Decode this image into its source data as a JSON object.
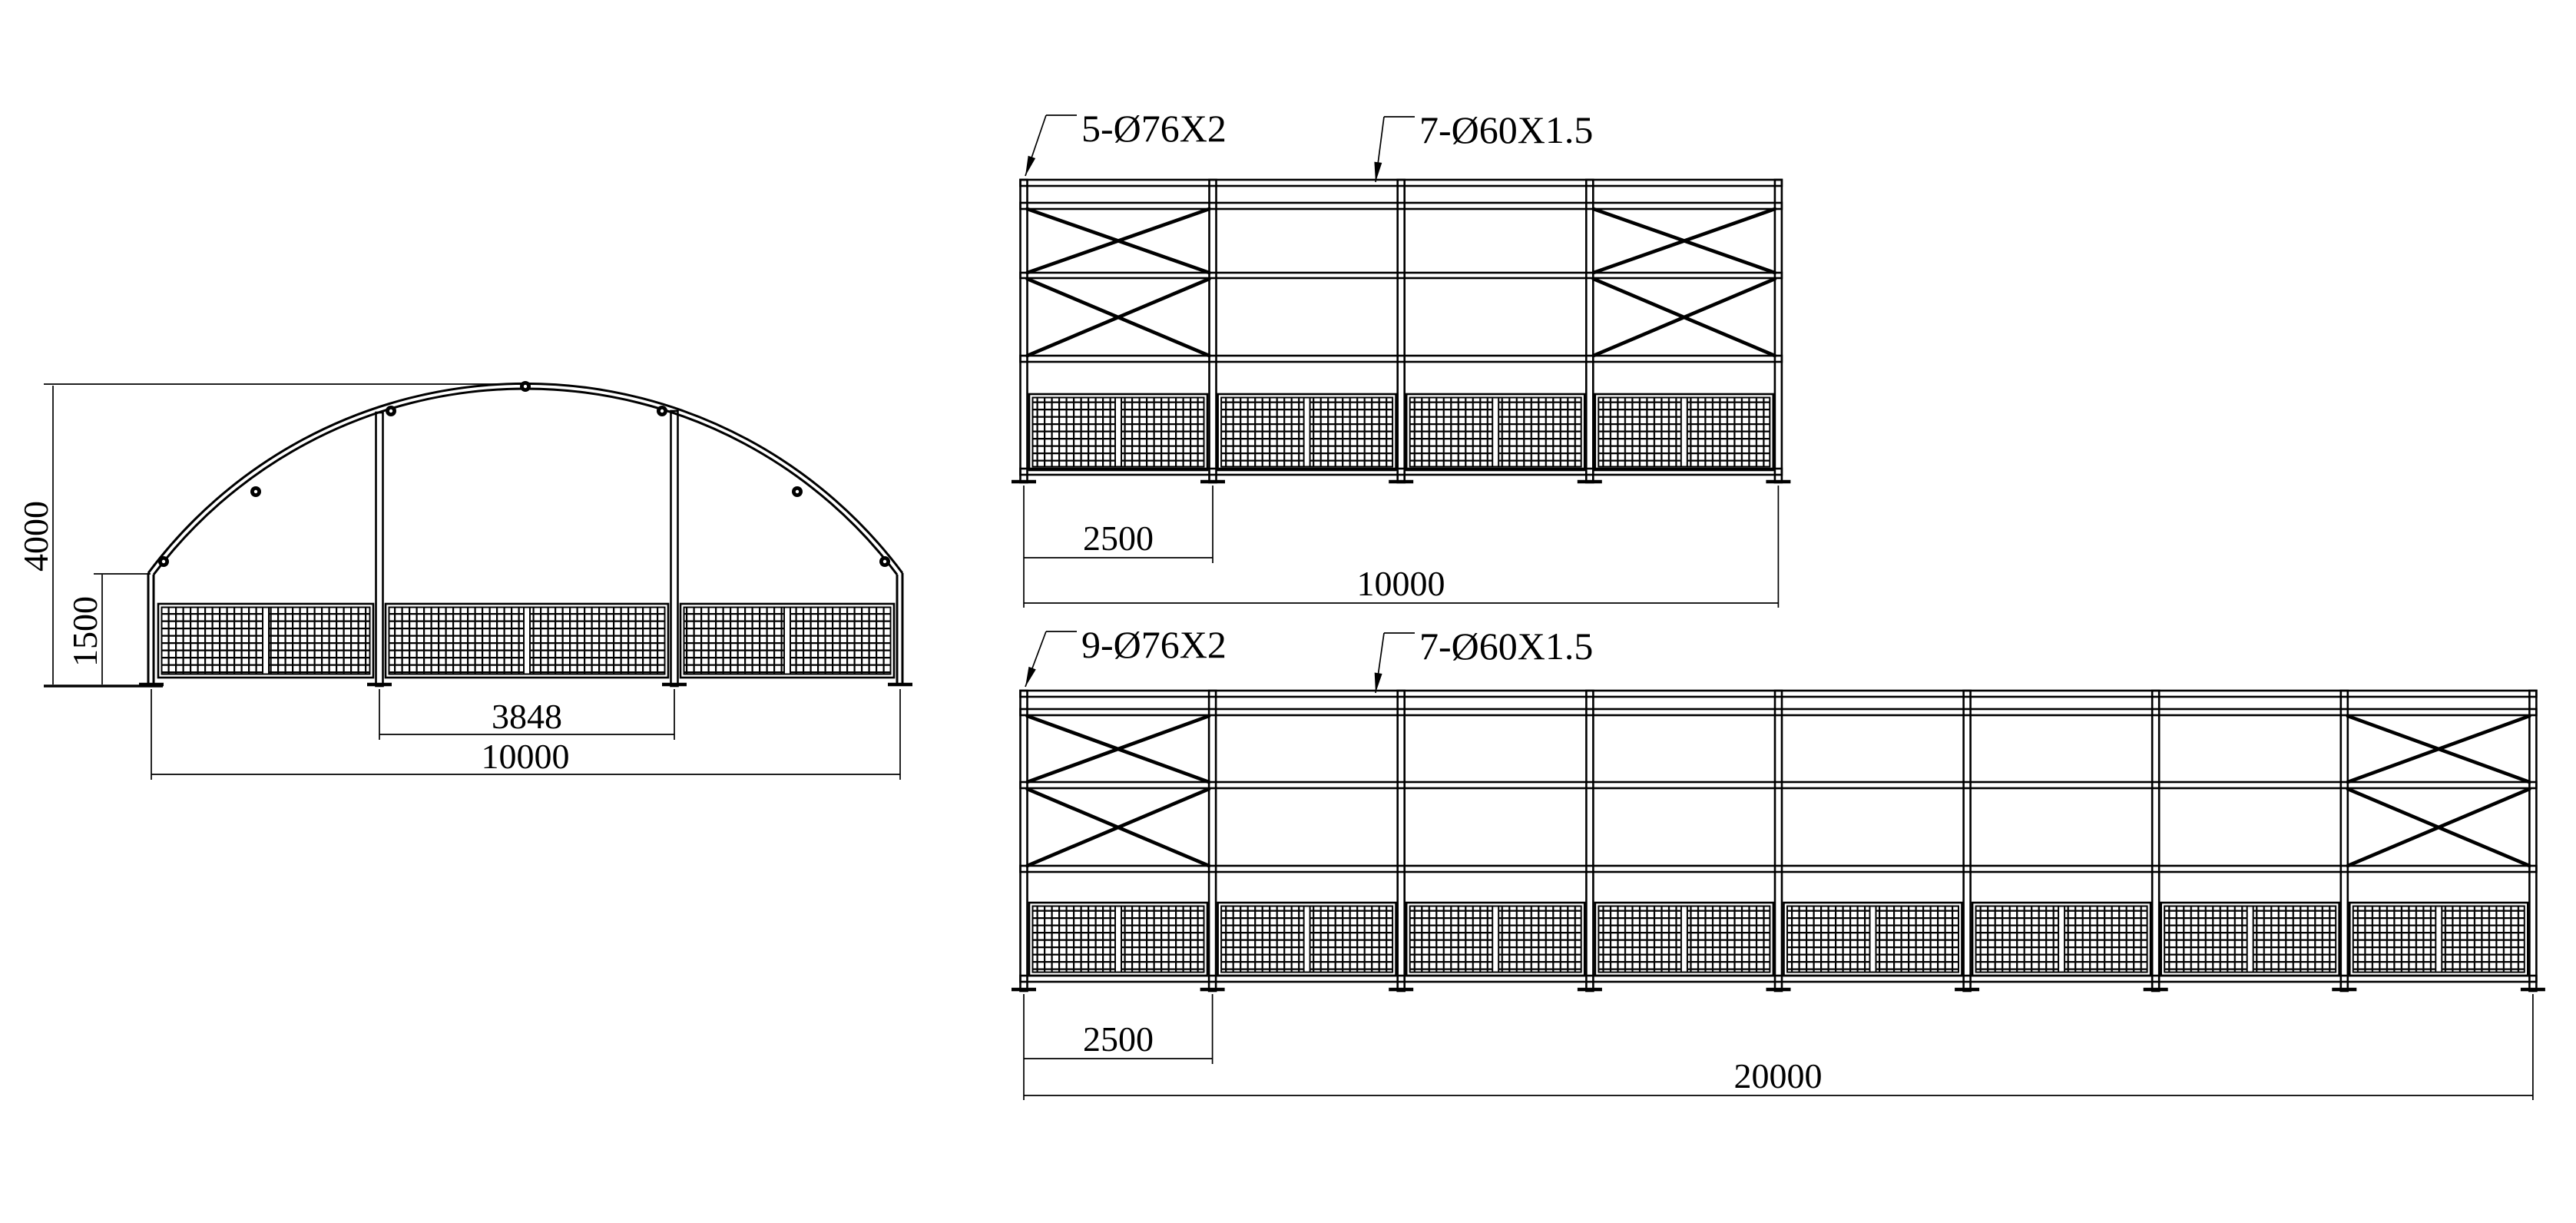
{
  "drawing": {
    "title": "arched-frame-structure-drawing",
    "background_color": "#ffffff",
    "line_color": "#000000",
    "front_view": {
      "dim_height": "4000",
      "dim_wall": "1500",
      "dim_span": "3848",
      "dim_width": "10000"
    },
    "side10": {
      "label_columns": "5-Ø76X2",
      "label_purlins": "7-Ø60X1.5",
      "dim_bay": "2500",
      "dim_total": "10000"
    },
    "side20": {
      "label_columns": "9-Ø76X2",
      "label_purlins": "7-Ø60X1.5",
      "dim_bay": "2500",
      "dim_total": "20000"
    }
  }
}
